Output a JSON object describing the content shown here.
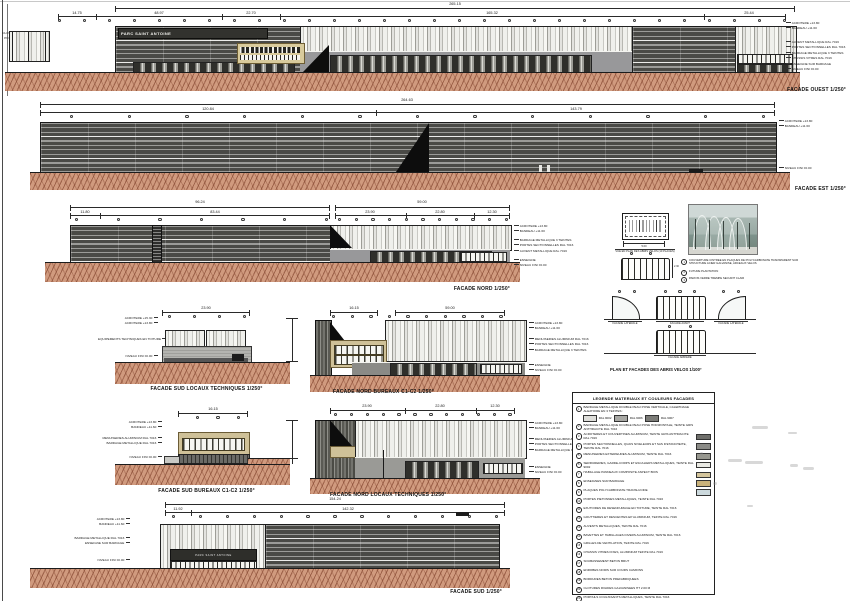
{
  "sheet": {
    "bg": "#ffffff"
  },
  "colors": {
    "ground": "#d09a7e",
    "dark_facade": "#4a4a46",
    "tan": "#cfc198",
    "ink": "#111111"
  },
  "ouest": {
    "title": "FACADE OUEST 1/250°",
    "sign": "PARC SAINT ANTOINE",
    "dim_total": "265.15",
    "dims": [
      "14.75",
      "48.97",
      "22.70",
      "165.32",
      "25.44"
    ],
    "fence_labels": [
      "CLOTURE HT 2.00 M",
      "PORTAIL HT 2.00 M"
    ],
    "ann_top": [
      "ACROTERE +13.80",
      "BANDEAU +11.60"
    ],
    "ann_mid": [
      "AUVENT METALLIQUE RAL 7016",
      "PORTES SECTIONNELLES RAL 7016",
      "BARDAGE METALLIQUE 3 TEINTES",
      "CHASSIS VITRES RAL 7016"
    ],
    "ann_bot": [
      "ENSEIGNE SUR BARDAGE",
      "NIVEAU FINI ±0.00"
    ]
  },
  "est": {
    "title": "FACADE EST 1/250°",
    "dim_total": "264.63",
    "dims": [
      "120.84",
      "143.79"
    ],
    "ann_top": [
      "ACROTERE +13.80",
      "BANDEAU +11.60"
    ],
    "ann_bot": [
      "NIVEAU FINI ±0.00"
    ]
  },
  "nord": {
    "title": "FACADE NORD 1/250°",
    "dim_total_l": "96.24",
    "dims_l": [
      "11.80",
      "83.44"
    ],
    "dim_total_r": "59.00",
    "dims_r": [
      "23.90",
      "22.80",
      "12.30"
    ],
    "ann_top": [
      "ACROTERE +13.80",
      "BANDEAU +11.60"
    ],
    "ann_mid": [
      "BARDAGE METALLIQUE 3 TEINTES",
      "PORTES SECTIONNELLES RAL 7016",
      "AUVENT METALLIQUE RAL 7016"
    ],
    "ann_bot": [
      "ENSEIGNE",
      "NIVEAU FINI ±0.00"
    ]
  },
  "sud_locaux": {
    "title": "FACADE SUD LOCAUX TECHNIQUES 1/250°",
    "dim": "23.90",
    "ann_top": [
      "ACROTERE +15.30",
      "ACROTERE +13.80"
    ],
    "ann_mid": [
      "EQUIPEMENTS TECHNIQUES EN TOITURE"
    ],
    "ann_bot": [
      "NIVEAU FINI ±0.00"
    ]
  },
  "nord_bureaux": {
    "title": "FACADE NORD BUREAUX C1-C2 1/250°",
    "dims": [
      "16.15",
      "59.00"
    ],
    "ann_top": [
      "ACROTERE +13.80",
      "BANDEAU +11.60"
    ],
    "ann_mid": [
      "MENUISERIES ALUMINIUM RAL 7016",
      "PORTES SECTIONNELLES RAL 7016",
      "BARDAGE METALLIQUE 3 TEINTES"
    ],
    "ann_bot": [
      "ENSEIGNE",
      "NIVEAU FINI ±0.00"
    ]
  },
  "sud_bureaux": {
    "title": "FACADE SUD BUREAUX C1-C2 1/250°",
    "dim": "16.15",
    "ann_top": [
      "ACROTERE +13.80",
      "BANDEAU +11.60"
    ],
    "ann_mid": [
      "MENUISERIES ALUMINIUM RAL 7016",
      "BARDAGE METALLIQUE RAL 7016"
    ],
    "ann_bot": [
      "NIVEAU FINI ±0.00"
    ]
  },
  "nord_locaux": {
    "title": "FACADE NORD LOCAUX TECHNIQUES 1/250°",
    "dims": [
      "23.90",
      "22.80",
      "12.30"
    ],
    "ann_top": [
      "ACROTERE +13.80",
      "BANDEAU +11.60"
    ],
    "ann_mid": [
      "MENUISERIES ALUMINIUM RAL 7016",
      "PORTES SECTIONNELLES RAL 7016",
      "BARDAGE METALLIQUE 3 TEINTES"
    ],
    "ann_bot": [
      "ENSEIGNE",
      "NIVEAU FINI ±0.00"
    ]
  },
  "sud": {
    "title": "FACADE SUD 1/250°",
    "dim_total": "154.24",
    "dims": [
      "11.92",
      "142.32"
    ],
    "sign": "PARC SAINT ANTOINE",
    "ann_top": [
      "ACROTERE +13.80",
      "BANDEAU +11.60"
    ],
    "ann_mid": [
      "BARDAGE METALLIQUE RAL 7016",
      "ENSEIGNE SUR BARDAGE"
    ],
    "ann_bot": [
      "NIVEAU FINI ±0.00"
    ]
  },
  "abris": {
    "title": "PLAN ET FACADES DES ABRIS VELOS 1/100°",
    "plan_label": "VUE EN PLAN DES ABRIS VELOS (10 PLACES)",
    "plan_dim": "5.00",
    "height_dim": "2.30",
    "labels": {
      "laterale": "FACADE LATERALE",
      "avant": "FACADE AVANT",
      "arriere": "FACADE ARRIERE"
    },
    "notes": [
      {
        "n": "1",
        "t": "COUVERTURE CINTREE EN PLAQUES DE POLYCARBONATE TRANSPARENT SUR STRUCTURE ACIER GALVANISE, ARCEAUX VELOS"
      },
      {
        "n": "2",
        "t": "FUTURE PLANTATION"
      },
      {
        "n": "3",
        "t": "PAROIS VERRE TREMPE SECURIT CLAIR"
      }
    ]
  },
  "legend": {
    "title": "LEGENDE MATERIAUX ET COULEURS FACADES",
    "item1_swatches": [
      {
        "label": "RAL 9002",
        "color": "#dededa"
      },
      {
        "label": "RAL 9006",
        "color": "#a9a9a5"
      },
      {
        "label": "RAL 9007",
        "color": "#7c7c78"
      }
    ],
    "items": [
      {
        "num": "1",
        "text": "BARDAGE METALLIQUE DOUBLE PEAU POSE VERTICALE, CALEPINAGE ALEATOIRE EN 3 TEINTES :",
        "swatch": ""
      },
      {
        "num": "2",
        "text": "BARDAGE METALLIQUE DOUBLE PEAU POSE HORIZONTALE, TEINTE GRIS ANTHRACITE RAL 7016",
        "swatch": ""
      },
      {
        "num": "3",
        "text": "ACROTERES ET COUVERTINES ALUMINIUM, TEINTE GRIS ANTHRACITE RAL 7016",
        "swatch": "#6f6f6b"
      },
      {
        "num": "4",
        "text": "PORTES SECTIONNELLES, QUAIS NIVELEURS ET SAS D'ETANCHEITE, TEINTE RAL 7016",
        "swatch": "#8b8b87"
      },
      {
        "num": "5",
        "text": "MENUISERIES EXTERIEURES ALUMINIUM, TEINTE RAL 7016",
        "swatch": "#97978f"
      },
      {
        "num": "6",
        "text": "SERRURERIES, GARDE-CORPS ET ESCALIERS METALLIQUES, TEINTE RAL 9002",
        "swatch": "#e9e9e3"
      },
      {
        "num": "7",
        "text": "HABILLAGE PANNEAUX COMPOSITE ASPECT BOIS",
        "swatch": "#d4c59c"
      },
      {
        "num": "8",
        "text": "ENSEIGNES SUR BARDAGE",
        "swatch": "#c9b27b"
      },
      {
        "num": "9",
        "text": "PLAQUES POLYCARBONATE TRANSLUCIDE",
        "swatch": "#ccd9dd"
      },
      {
        "num": "10",
        "text": "PORTES PIETONNES METALLIQUES, TEINTE RAL 7016",
        "swatch": ""
      },
      {
        "num": "11",
        "text": "EXUTOIRES DE DESENFUMAGE EN TOITURE, TEINTE RAL 7016",
        "swatch": ""
      },
      {
        "num": "12",
        "text": "GOUTTIERES ET DESCENTES EP ALUMINIUM, TEINTE RAL 7016",
        "swatch": ""
      },
      {
        "num": "13",
        "text": "AUVENTS METALLIQUES, TEINTE RAL 7016",
        "swatch": ""
      },
      {
        "num": "14",
        "text": "BAVETTES ET HABILLAGES DIVERS ALUMINIUM, TEINTE RAL 7016",
        "swatch": ""
      },
      {
        "num": "15",
        "text": "GRILLES DE VENTILATION, TEINTE RAL 7016",
        "swatch": ""
      },
      {
        "num": "16",
        "text": "CHASSIS VITRES FIXES, ALUMINIUM TEINTE RAL 7016",
        "swatch": ""
      },
      {
        "num": "17",
        "text": "SOUBASSEMENT BETON BRUT",
        "swatch": ""
      },
      {
        "num": "18",
        "text": "ENROBES NOIRS SUR COURS CAMIONS",
        "swatch": ""
      },
      {
        "num": "19",
        "text": "BORDURES BETON PREFABRIQUEES",
        "swatch": ""
      },
      {
        "num": "20",
        "text": "CLOTURES RIGIDES GALVANISEES HT 2.00 M",
        "swatch": ""
      },
      {
        "num": "21",
        "text": "PORTAILS COULISSANTS METALLIQUES, TEINTE RAL 7016",
        "swatch": ""
      },
      {
        "num": "22",
        "text": "ESPACES VERTS ENGAZONNES ET PLANTATIONS",
        "swatch": ""
      }
    ]
  }
}
